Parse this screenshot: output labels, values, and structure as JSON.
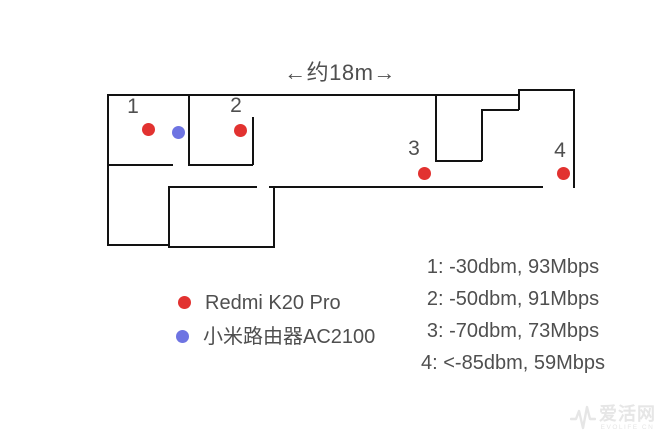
{
  "diagram": {
    "dimension_label": "←约18m→",
    "points": [
      {
        "label": "1"
      },
      {
        "label": "2"
      },
      {
        "label": "3"
      },
      {
        "label": "4"
      }
    ]
  },
  "legend": {
    "items": [
      {
        "label": "Redmi K20 Pro",
        "marker": "red-dot"
      },
      {
        "label": "小米路由器AC2100",
        "marker": "blue-dot"
      }
    ]
  },
  "readings": [
    {
      "text": "1: -30dbm, 93Mbps"
    },
    {
      "text": "2: -50dbm, 91Mbps"
    },
    {
      "text": "3: -70dbm, 73Mbps"
    },
    {
      "text": "4: <-85dbm, 59Mbps"
    }
  ],
  "watermark": {
    "brand": "爱活网",
    "caption": "EVOLIFE CN"
  },
  "colors": {
    "phone_dot": "#e23230",
    "router_dot": "#6e74e2",
    "wall": "#121212",
    "label": "#4f4f4f",
    "watermark": "#e6e6e6"
  }
}
